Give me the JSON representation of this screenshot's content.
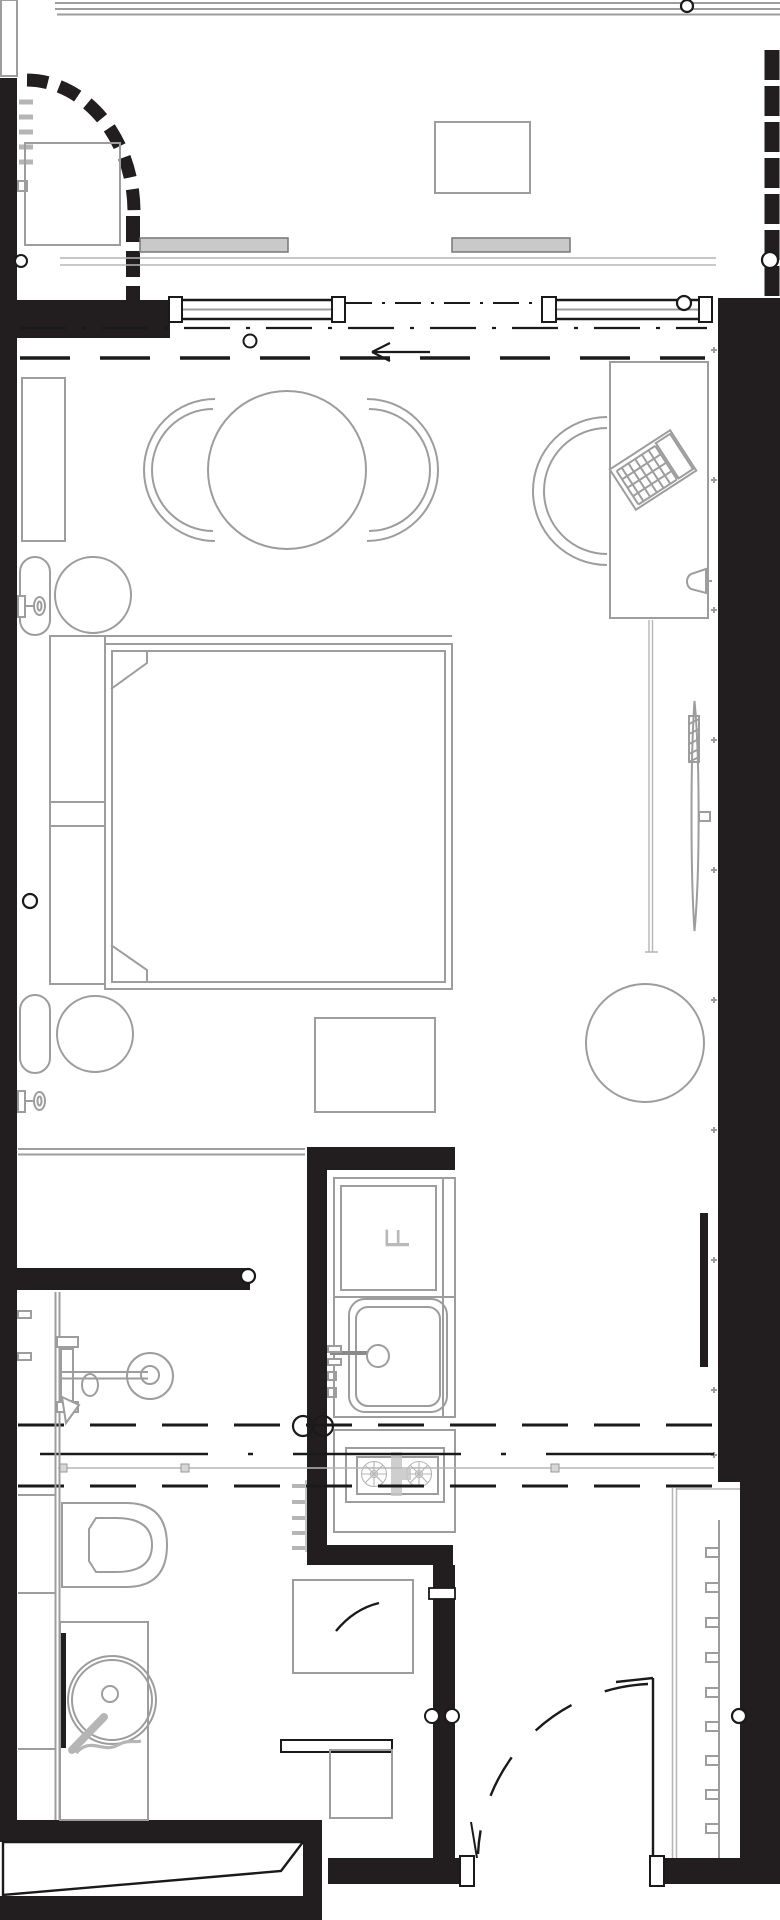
{
  "document": {
    "type": "floor-plan",
    "description": "Black and white architectural floor plan of a studio hotel room with balcony, living and sleeping area, kitchenette, bathroom and entry hall"
  },
  "theme": {
    "bg": "#ffffff",
    "wall": "#221e1f",
    "line_strong": "#1a1a1a",
    "line_furniture": "#9d9d9d",
    "line_light": "#b5b5b5",
    "panel_fill": "#c9c9c9",
    "label": "#b9b9b9"
  },
  "labels": {
    "fridge": "F"
  },
  "areas": {
    "balcony": {
      "elements": [
        "balcony-railing",
        "privacy-screen-arc",
        "wall-ladder",
        "planter-box",
        "balcony-table"
      ]
    },
    "facade": {
      "elements": [
        "sliding-glass-door",
        "door-track",
        "entry-direction-arrow",
        "ceiling-dash-line"
      ]
    },
    "living": {
      "elements": [
        "wardrobe",
        "dining-table",
        "dining-chair-left",
        "dining-chair-right",
        "desk",
        "laptop",
        "desk-chair",
        "wall-sconce",
        "wall-tv",
        "curtain-track",
        "lounge-chair"
      ]
    },
    "sleeping": {
      "elements": [
        "double-bed",
        "pillows",
        "bedside-console",
        "bedside-stool-top",
        "bedside-stool-bottom",
        "bedside-sconce-top",
        "bedside-sconce-bottom",
        "foot-bench",
        "closet-shelf-line"
      ]
    },
    "kitchenette": {
      "elements": [
        "kitchen-counter",
        "fridge",
        "kitchen-sink",
        "kitchen-faucet",
        "cooktop-burners",
        "towel-rail",
        "service-circles"
      ]
    },
    "bathroom": {
      "elements": [
        "vanity-counter",
        "washbasin",
        "mixer-tap",
        "toilet",
        "shower-enclosure",
        "shower-drain",
        "grab-bar",
        "shower-hose",
        "shower-glass"
      ]
    },
    "entry": {
      "elements": [
        "entry-door",
        "door-swing-arc",
        "coat-rack",
        "doormat-a",
        "doormat-b",
        "threshold-ramp",
        "door-jambs"
      ]
    }
  }
}
